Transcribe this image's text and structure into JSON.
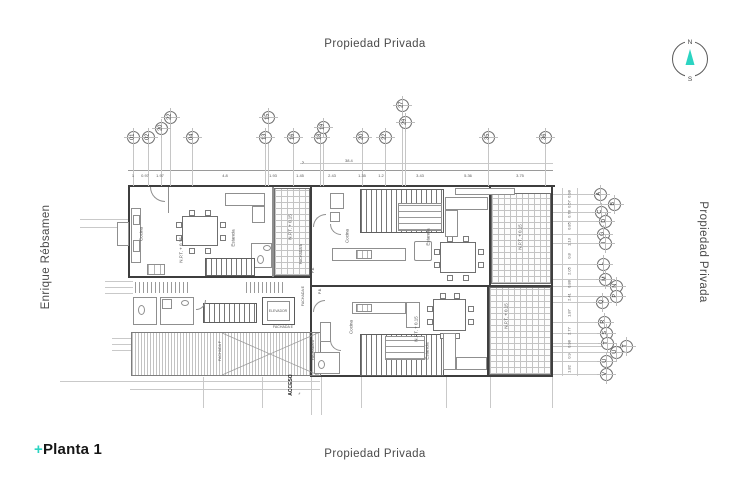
{
  "accent": "#2bd4c2",
  "title_block": {
    "plus": "+",
    "title": "Planta 1"
  },
  "surroundings": {
    "top": "Propiedad Privada",
    "bottom": "Propiedad Privada",
    "right": "Propiedad Privada",
    "left": "Enrique Rébsamen"
  },
  "compass": {
    "north": "N",
    "south": "S"
  },
  "grid": {
    "top_bubbles": [
      {
        "label": "01",
        "x": 133,
        "y": 137
      },
      {
        "label": "02",
        "x": 148,
        "y": 137
      },
      {
        "label": "20",
        "x": 161,
        "y": 128
      },
      {
        "label": "22",
        "x": 170,
        "y": 117
      },
      {
        "label": "04",
        "x": 192,
        "y": 137
      },
      {
        "label": "13",
        "x": 265,
        "y": 137
      },
      {
        "label": "15",
        "x": 268,
        "y": 117
      },
      {
        "label": "16",
        "x": 293,
        "y": 137
      },
      {
        "label": "18",
        "x": 320,
        "y": 137
      },
      {
        "label": "19",
        "x": 323,
        "y": 127
      },
      {
        "label": "20",
        "x": 362,
        "y": 137
      },
      {
        "label": "22",
        "x": 385,
        "y": 137
      },
      {
        "label": "27",
        "x": 402,
        "y": 105
      },
      {
        "label": "29",
        "x": 405,
        "y": 122
      },
      {
        "label": "35",
        "x": 488,
        "y": 137
      },
      {
        "label": "36",
        "x": 545,
        "y": 137
      }
    ],
    "right_bubbles": [
      {
        "label": "A",
        "x": 600,
        "y": 194
      },
      {
        "label": "B",
        "x": 614,
        "y": 204
      },
      {
        "label": "C",
        "x": 601,
        "y": 212
      },
      {
        "label": "D",
        "x": 605,
        "y": 221
      },
      {
        "label": "G",
        "x": 603,
        "y": 234
      },
      {
        "label": "I",
        "x": 605,
        "y": 243
      },
      {
        "label": "L",
        "x": 603,
        "y": 264
      },
      {
        "label": "M",
        "x": 605,
        "y": 279
      },
      {
        "label": "N",
        "x": 616,
        "y": 286
      },
      {
        "label": "P",
        "x": 616,
        "y": 296
      },
      {
        "label": "Q",
        "x": 602,
        "y": 302
      },
      {
        "label": "R",
        "x": 604,
        "y": 322
      },
      {
        "label": "S",
        "x": 606,
        "y": 333
      },
      {
        "label": "T",
        "x": 607,
        "y": 343
      },
      {
        "label": "T",
        "x": 626,
        "y": 346
      },
      {
        "label": "U",
        "x": 616,
        "y": 352
      },
      {
        "label": "U",
        "x": 606,
        "y": 361
      },
      {
        "label": "V",
        "x": 606,
        "y": 374
      }
    ]
  },
  "plan_labels": [
    {
      "text": "Cocina",
      "x": 141,
      "y": 234,
      "rot": -90
    },
    {
      "text": "Estancia",
      "x": 233,
      "y": 238,
      "rot": -90
    },
    {
      "text": "N.P.T. + 0.15",
      "x": 181,
      "y": 250,
      "rot": -90
    },
    {
      "text": "N.P.T. + 0.15",
      "x": 290,
      "y": 227,
      "rot": -90
    },
    {
      "text": "FACHADA  B",
      "x": 301,
      "y": 254,
      "rot": -90,
      "s": 3.6
    },
    {
      "text": "Cocina",
      "x": 347,
      "y": 236,
      "rot": -90
    },
    {
      "text": "Estancia",
      "x": 428,
      "y": 237,
      "rot": -90
    },
    {
      "text": "N.P.T. + 0.15",
      "x": 520,
      "y": 237,
      "rot": -90
    },
    {
      "text": "P.B.",
      "x": 313,
      "y": 270,
      "rot": -90,
      "s": 3.6
    },
    {
      "text": "FACHADA  E",
      "x": 303,
      "y": 296,
      "rot": -90,
      "s": 3.6
    },
    {
      "text": "P.B.",
      "x": 320,
      "y": 291,
      "rot": -90,
      "s": 3.6
    },
    {
      "text": "Cocina",
      "x": 351,
      "y": 327,
      "rot": -90
    },
    {
      "text": "N.P.T. + 0.15",
      "x": 416,
      "y": 329,
      "rot": -90
    },
    {
      "text": "Estancia",
      "x": 427,
      "y": 351,
      "rot": -90
    },
    {
      "text": "N.P.T. + 0.15",
      "x": 506,
      "y": 316,
      "rot": -90
    },
    {
      "text": "ELEVADOR",
      "x": 278,
      "y": 311,
      "rot": 0,
      "s": 3.4
    },
    {
      "text": "FACHADA  E",
      "x": 283,
      "y": 327,
      "rot": 0,
      "s": 3.6
    },
    {
      "text": "FACHADA  F",
      "x": 220,
      "y": 351,
      "rot": -90,
      "s": 3.6
    },
    {
      "text": "FACHADA  D",
      "x": 313,
      "y": 350,
      "rot": -90,
      "s": 3.6
    },
    {
      "text": "ACCESO",
      "x": 291,
      "y": 385,
      "rot": -90,
      "s": 5,
      "b": true
    },
    {
      "text": "›",
      "x": 303,
      "y": 163,
      "rot": 0,
      "s": 6
    },
    {
      "text": "›",
      "x": 299,
      "y": 394,
      "rot": 45,
      "s": 6
    }
  ],
  "dimensions": {
    "overall_width": "38.4",
    "top": [
      {
        "v": "1",
        "x": 133
      },
      {
        "v": "0.97",
        "x": 145
      },
      {
        "v": "1.97",
        "x": 160
      },
      {
        "v": "4.8",
        "x": 225
      },
      {
        "v": "1.93",
        "x": 273
      },
      {
        "v": "1.45",
        "x": 300
      },
      {
        "v": "2.43",
        "x": 332
      },
      {
        "v": "1.35",
        "x": 362
      },
      {
        "v": "1.2",
        "x": 381
      },
      {
        "v": "3.43",
        "x": 420
      },
      {
        "v": "5.36",
        "x": 468
      },
      {
        "v": "3.75",
        "x": 520
      }
    ],
    "right": [
      {
        "v": "0.98",
        "y": 194
      },
      {
        "v": "0.57",
        "y": 204
      },
      {
        "v": "0.78",
        "y": 214
      },
      {
        "v": "0.85",
        "y": 226
      },
      {
        "v": "1.13",
        "y": 242
      },
      {
        "v": "0.8",
        "y": 256
      },
      {
        "v": "2.05",
        "y": 271
      },
      {
        "v": "0.88",
        "y": 284
      },
      {
        "v": "2.41",
        "y": 297
      },
      {
        "v": "1.87",
        "y": 313
      },
      {
        "v": "2.77",
        "y": 331
      },
      {
        "v": "0.98",
        "y": 344
      },
      {
        "v": "0.9",
        "y": 356
      },
      {
        "v": "1.82",
        "y": 369
      }
    ]
  }
}
